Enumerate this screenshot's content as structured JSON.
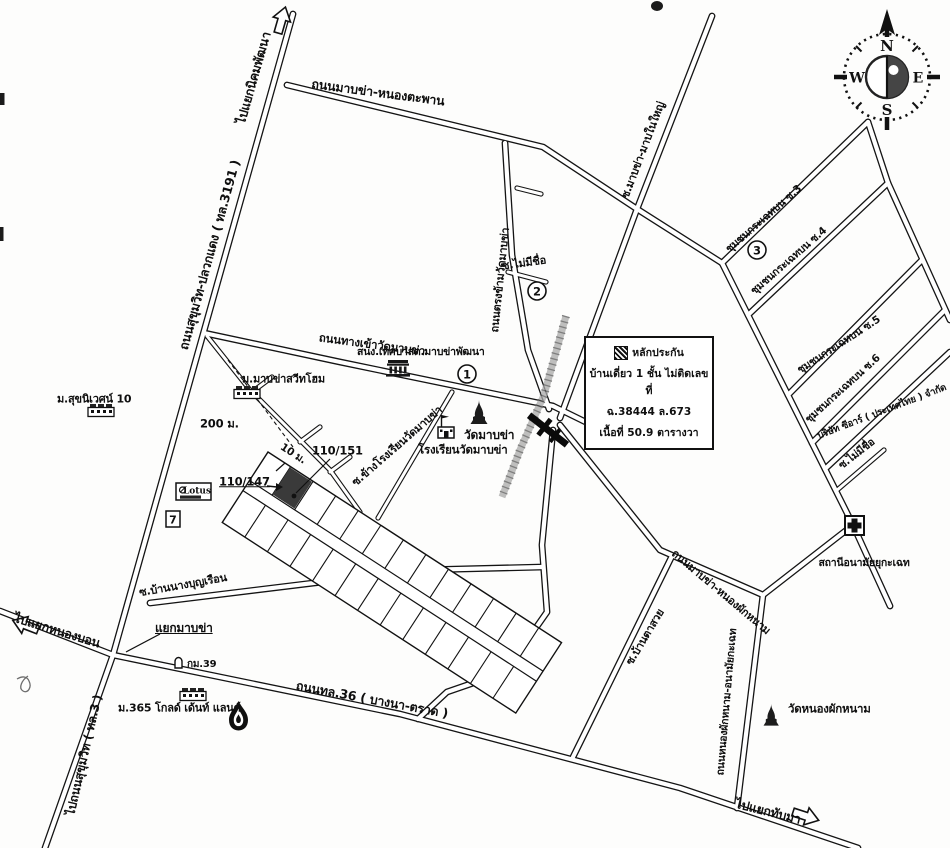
{
  "map": {
    "info_box": {
      "line1": "หลักประกัน",
      "line2": "บ้านเดี่ยว 1 ชั้น ไม่ติดเลขที่",
      "line3": "ฉ.38444 ล.673",
      "line4": "เนื้อที่ 50.9 ตารางวา"
    },
    "compass": {
      "n": "N",
      "e": "E",
      "s": "S",
      "w": "W"
    },
    "markers": {
      "lotus": "Lotus",
      "seven": "7",
      "c1": "1",
      "c2": "2",
      "c3": "3"
    },
    "labels": [
      {
        "id": "to_nikhom",
        "text": "ไปแยกนิคมพัฒนา"
      },
      {
        "id": "rd_nongtaphan",
        "text": "ถนนมาบข่า-หนองตะพาน"
      },
      {
        "id": "rd_sukhumvit_pluak",
        "text": "ถนนสุขุมวิท-ปลวกแดง ( ทล.3191 )"
      },
      {
        "id": "soi_mapnai",
        "text": "ซ.มาบข่า-มาบในใหญ่"
      },
      {
        "id": "rd_trongkham",
        "text": "ถนนตรงข้ามวัดมาบข่า"
      },
      {
        "id": "soi_noname_c",
        "text": "ซ.ไม่มีชื่อ"
      },
      {
        "id": "comm3",
        "text": "ชุมชนกระเฉทบน ซ.3"
      },
      {
        "id": "comm4",
        "text": "ชุมชนกระเฉทบน ซ.4"
      },
      {
        "id": "comm5",
        "text": "ชุมชนกระเฉทบน ซ.5"
      },
      {
        "id": "comm6",
        "text": "ชุมชนกระเฉทบน ซ.6"
      },
      {
        "id": "cr",
        "text": "บริษัท ซีอาร์ ( ประเทศไทย ) จำกัด"
      },
      {
        "id": "soi_noname_r",
        "text": "ซ.ไม่มีชื่อ"
      },
      {
        "id": "anamai",
        "text": "สถานีอนามัยยุกะเฉท"
      },
      {
        "id": "rd_anamai",
        "text": "ถนนหนองผักหนาม-อนามัยกะเฉท"
      },
      {
        "id": "wat_nong",
        "text": "วัดหนองผักหนาม"
      },
      {
        "id": "to_thapma",
        "text": "ไปแยกทับมา"
      },
      {
        "id": "rd36",
        "text": "ถนนทล.36 ( บางนา-ตราด )"
      },
      {
        "id": "soi_tasuay",
        "text": "ซ.บ้านตาสวย"
      },
      {
        "id": "rd_mapkha_nong",
        "text": "ถนนมาบข่า-หนองผักหนาม"
      },
      {
        "id": "soi_bunruean",
        "text": "ซ.บ้านนางบุญเรือน"
      },
      {
        "id": "yaek_mapkha",
        "text": "แยกมาบข่า"
      },
      {
        "id": "to_nongbon",
        "text": "ไปแยกหนองบอน"
      },
      {
        "id": "km39",
        "text": "กม.39"
      },
      {
        "id": "m365",
        "text": "ม.365 โกลด์ เด้นท์ แลนด์"
      },
      {
        "id": "to_sukhumvit3",
        "text": "ไปถนนสุขุมวิท ( ทล.3 )"
      },
      {
        "id": "suknivet",
        "text": "ม.สุขนิเวศน์ 10"
      },
      {
        "id": "rd_entrance",
        "text": "ถนนทางเข้าวัดมาบข่า"
      },
      {
        "id": "sweethome",
        "text": "ม.มาบข่าสวีทโฮม"
      },
      {
        "id": "tessaban",
        "text": "สนง.เทศบาลต.มาบข่าพัฒนา"
      },
      {
        "id": "d200",
        "text": "200 ม."
      },
      {
        "id": "d10",
        "text": "10 ม."
      },
      {
        "id": "h151",
        "text": "110/151"
      },
      {
        "id": "h147",
        "text": "110/147"
      },
      {
        "id": "soi_khang",
        "text": "ซ.ข้างโรงเรียนวัดมาบข่า"
      },
      {
        "id": "school",
        "text": "โรงเรียนวัดมาบข่า"
      },
      {
        "id": "wat_mapkha",
        "text": "วัดมาบข่า"
      }
    ]
  }
}
